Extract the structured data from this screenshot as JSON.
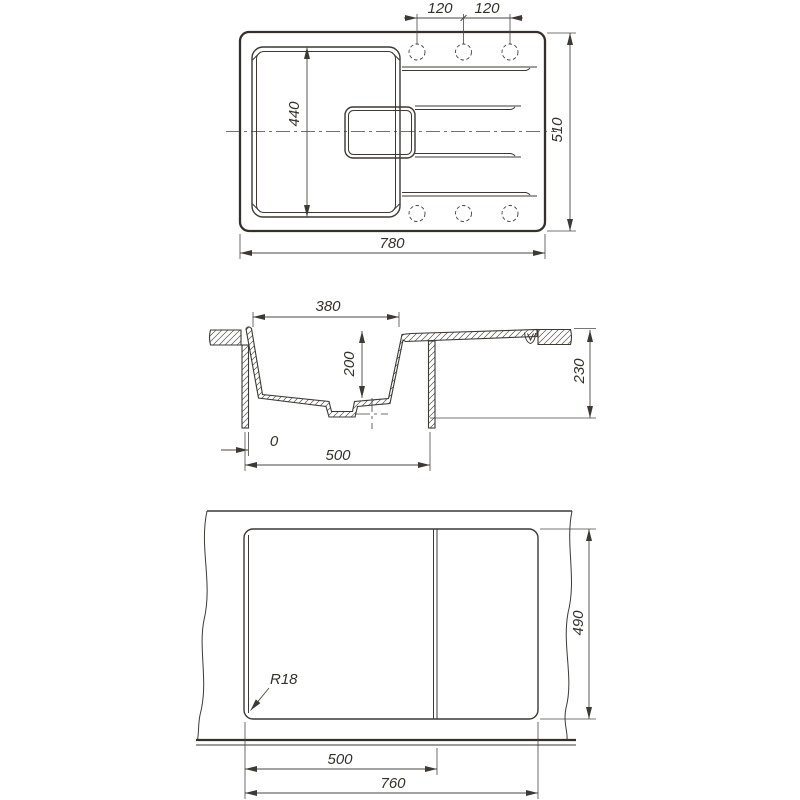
{
  "title": "Kitchen sink engineering drawing — three orthographic views",
  "colors": {
    "line": "#3c3936",
    "dim": "#4a4744",
    "background": "#ffffff"
  },
  "top_view": {
    "label": "top-view",
    "dims": {
      "hole_spacing_left": "120",
      "hole_spacing_right": "120",
      "bowl_length": "440",
      "overall_width": "780",
      "overall_depth": "510"
    }
  },
  "section_view": {
    "label": "section-view",
    "dims": {
      "bowl_width": "380",
      "bowl_depth": "200",
      "total_height": "230",
      "edge_offset": "0",
      "cabinet_width": "500"
    }
  },
  "cutout_view": {
    "label": "cutout-view",
    "dims": {
      "corner_radius": "R18",
      "left_section_width": "500",
      "cutout_width": "760",
      "cutout_depth": "490"
    }
  }
}
